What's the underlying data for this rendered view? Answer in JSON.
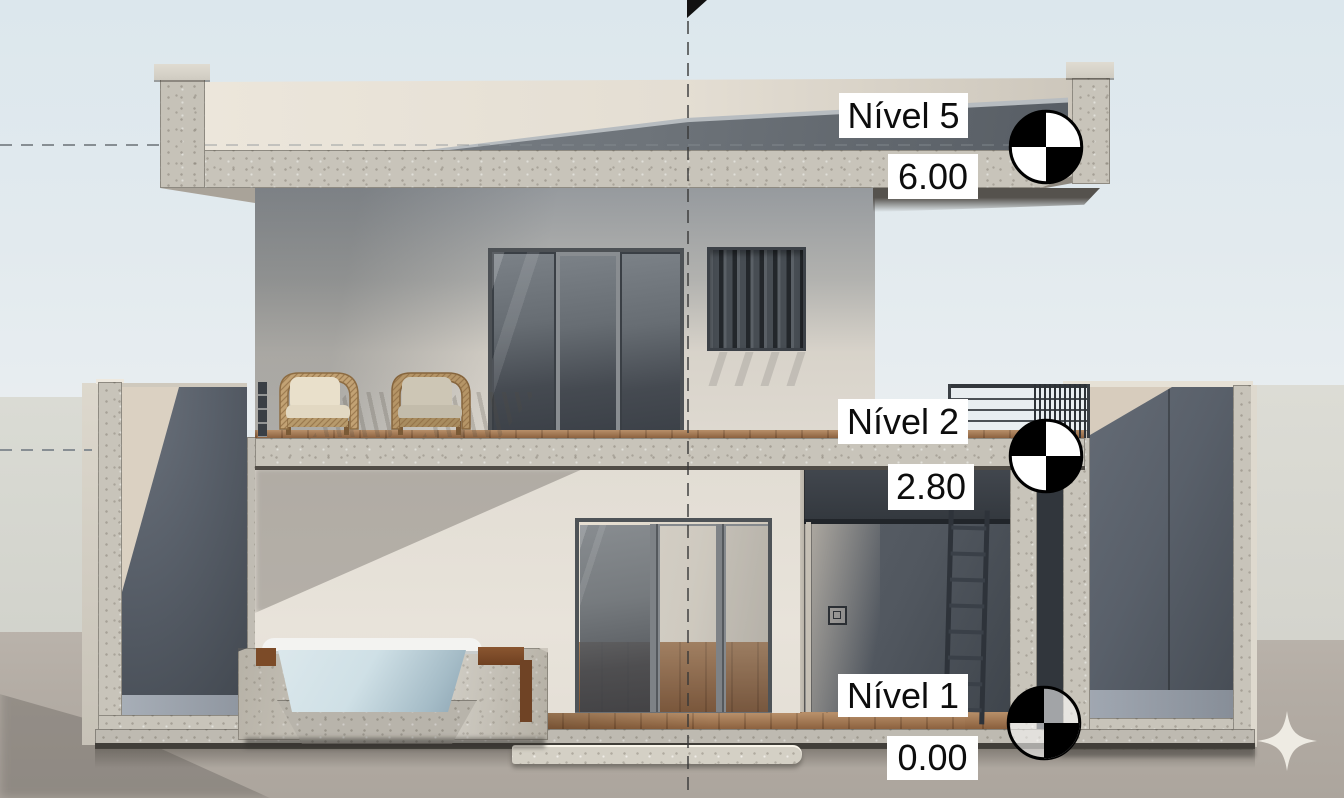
{
  "view": {
    "type": "building-section-elevation",
    "annotations": {
      "levels": [
        {
          "name": "Nível 5",
          "elevation": "6.00"
        },
        {
          "name": "Nível 2",
          "elevation": "2.80"
        },
        {
          "name": "Nível 1",
          "elevation": "0.00"
        }
      ],
      "datum_icon": "level-datum-target",
      "section_marker_icon": "section-flag"
    },
    "watermark": {
      "icon": "sparkle"
    },
    "colors": {
      "sky_top": "#dce7ed",
      "sky_bottom": "#e9eef1",
      "background_band": "#d6d6cf",
      "ground": "#b3aca4",
      "concrete_cut": "#c8c4ba",
      "facade_light": "#e7e2d9",
      "facade_shadow": "#979a9e",
      "interior_dark": "#575d66",
      "roof_membrane": "#6e747a",
      "glass": "#565b62",
      "wood_deck": "#a0714a",
      "water": "#cfe0e6",
      "label_bg": "#ffffff",
      "label_text": "#111111"
    }
  }
}
